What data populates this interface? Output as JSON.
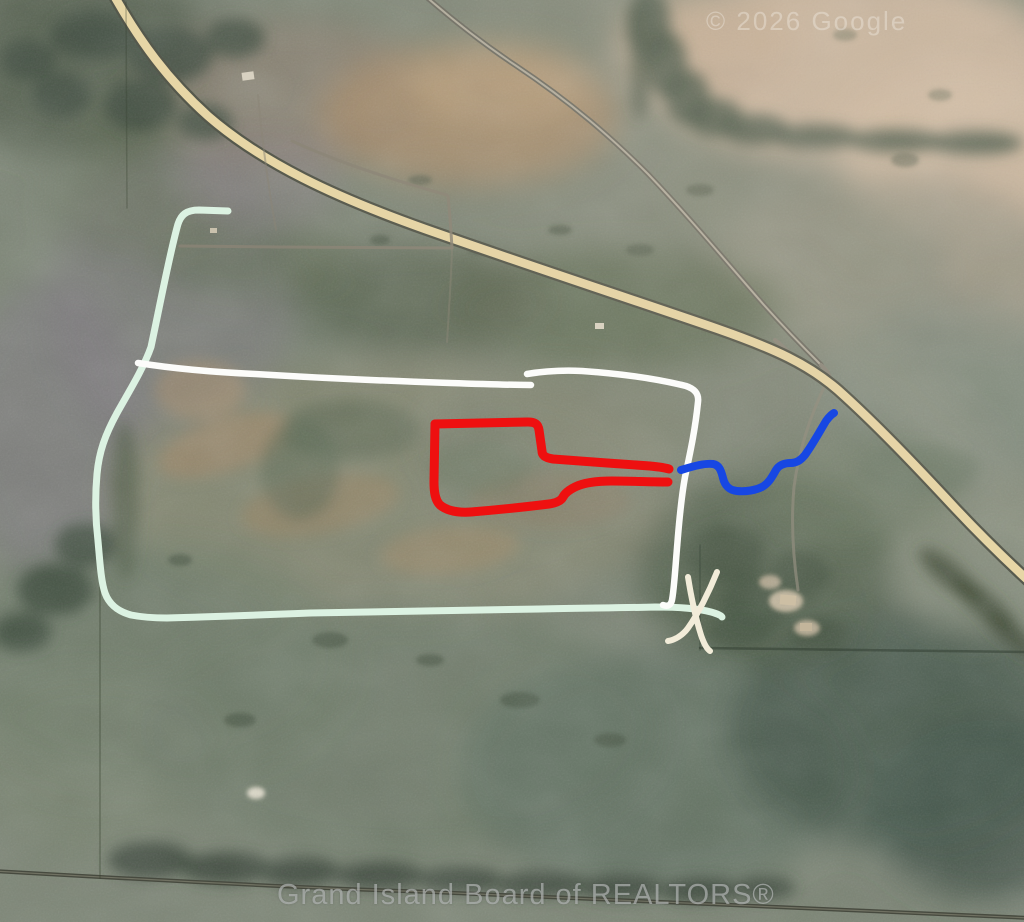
{
  "map": {
    "watermarks": {
      "top_right": "© 2026 Google",
      "bottom": "Grand Island Board of REALTORS®"
    },
    "palette": {
      "highway": "#e7d6a6",
      "mint_line": "#dcf2e2",
      "white_line": "#fcfcfa",
      "red_line": "#ee1010",
      "blue_line": "#1747e3",
      "x_mark": "#f2ecd9"
    },
    "annotations": [
      {
        "name": "outer-boundary-line-mint",
        "color": "#dcf2e2",
        "width": 7,
        "paths": [
          "M 228,211 L 199,210 C 186,210 181,215 178,224 C 170,252 161,300 151,347 C 144,367 130,390 117,413 C 105,435 99,452 97,474 C 95,496 95,516 98,541 C 100,563 101,581 105,593 C 109,604 117,611 131,615 C 141,617 152,618 167,618 C 210,617 260,615 310,613 C 400,611 470,610 540,609 C 580,608 620,608 655,607 C 680,607 700,609 711,612 C 718,614 722,616 722,617"
        ]
      },
      {
        "name": "north-boundary-line-white",
        "color": "#fcfcfa",
        "width": 6.5,
        "paths": [
          "M 138,363 C 170,368 210,372 255,374 C 320,378 390,381 450,383 C 480,384 510,385 531,385",
          "M 527,374 C 545,371 562,370 582,371 C 625,374 662,380 686,386 C 695,389 699,394 698,402 C 695,432 689,458 685,477 C 681,499 679,522 677,548 C 675,572 674,590 672,600 C 671,605 668,607 663,605"
        ]
      },
      {
        "name": "red-parcel-outline",
        "color": "#ee1010",
        "width": 9,
        "paths": [
          "M 435,424 L 528,422 C 535,422 538,424 539,430 L 542,451 C 542,456 546,458 553,459 C 580,461 620,464 650,466 C 660,467 666,468 669,469",
          "M 668,482 C 650,482 630,481 612,481 C 595,481 583,483 575,487 C 569,490 565,493 563,497 C 561,501 556,503 549,504 C 525,507 495,510 471,512 C 456,513 446,510 440,505 C 435,500 434,492 434,482 L 435,424"
        ]
      },
      {
        "name": "blue-stream-line",
        "color": "#1747e3",
        "width": 8,
        "paths": [
          "M 681,470 C 694,466 705,463 713,464 C 719,465 721,470 723,478 C 725,486 729,490 737,491 C 746,492 756,490 762,487 C 769,483 772,477 776,470 C 779,465 784,463 791,463 C 796,463 801,460 805,455 C 813,444 820,431 826,421 C 829,417 832,414 834,413"
        ]
      },
      {
        "name": "x-location-mark",
        "color": "#f2ecd9",
        "width": 6,
        "paths": [
          "M 717,572 C 709,592 698,614 688,628 C 683,635 675,640 668,641",
          "M 688,577 C 691,596 696,619 701,635 C 704,644 707,649 710,651"
        ]
      }
    ]
  }
}
